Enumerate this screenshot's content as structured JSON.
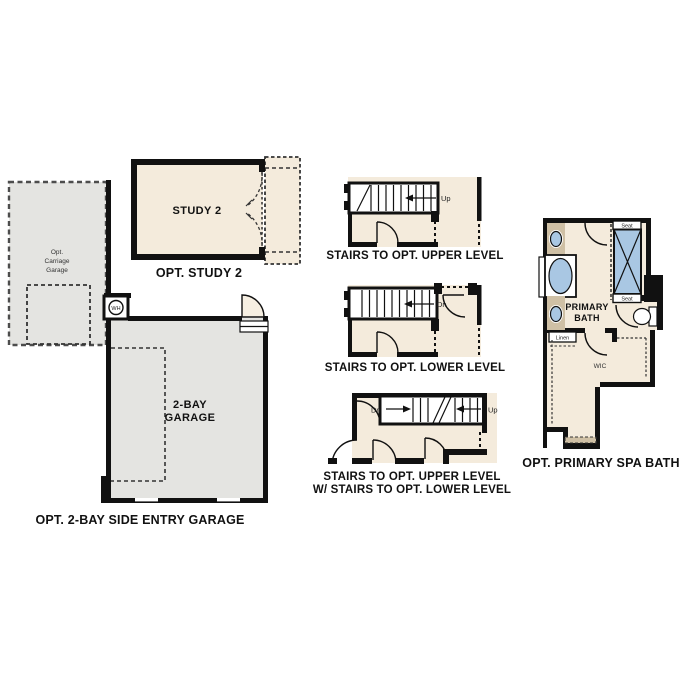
{
  "canvas": {
    "background": "#ffffff"
  },
  "colors": {
    "room_beige": "#f4ebdc",
    "garage_gray": "#e4e4e1",
    "wall_black": "#111111",
    "counter_tan": "#cfc0a5",
    "fixture_blue": "#a9c7e3"
  },
  "garage": {
    "caption": "OPT. 2-BAY SIDE ENTRY GARAGE",
    "room_line1": "2-BAY",
    "room_line2": "GARAGE",
    "carriage_line1": "Opt.",
    "carriage_line2": "Carriage",
    "carriage_line3": "Garage",
    "water_heater_label": "WH"
  },
  "study": {
    "caption": "OPT. STUDY 2",
    "room_label": "STUDY 2"
  },
  "stairs_upper": {
    "caption": "STAIRS TO OPT. UPPER LEVEL",
    "dir": "Up"
  },
  "stairs_lower": {
    "caption": "STAIRS TO OPT. LOWER LEVEL",
    "dir": "Dn"
  },
  "stairs_combo": {
    "caption_line1": "STAIRS TO OPT. UPPER LEVEL",
    "caption_line2": "W/ STAIRS TO OPT. LOWER LEVEL",
    "down": "Dn",
    "up": "Up"
  },
  "bath": {
    "caption": "OPT. PRIMARY SPA BATH",
    "room_line1": "PRIMARY",
    "room_line2": "BATH",
    "seat_top": "Seat",
    "seat_bottom": "Seat",
    "linen_label": "Linen",
    "wic_label": "WIC"
  }
}
